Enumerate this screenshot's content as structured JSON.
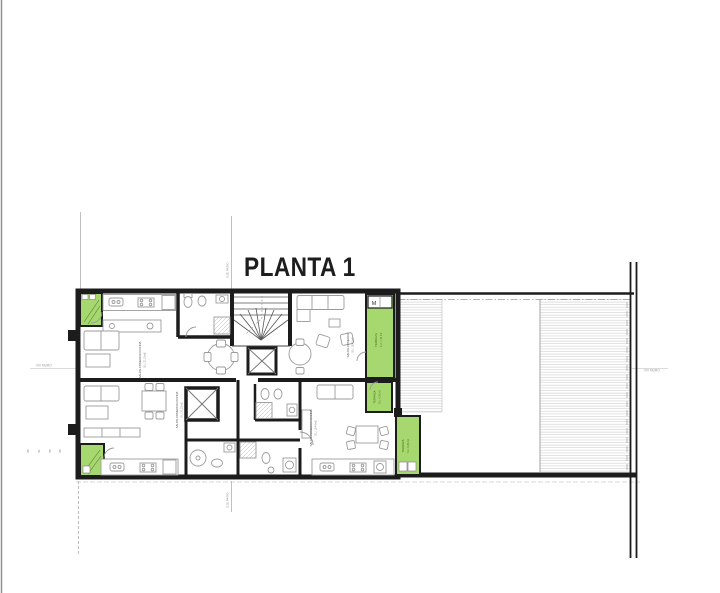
{
  "title": "PLANTA 1",
  "colors": {
    "wall": "#1c1c1c",
    "terrace_green": "#a7d86f",
    "terrace_border": "#3c660f",
    "furniture_gray": "#9b9b9b",
    "hatch_gray": "#cfcfcf",
    "reference_gray": "#a8a8a8",
    "background": "#ffffff"
  },
  "units": [
    {
      "id": "top-left",
      "label": "SALON-COMEDOR-COCINA",
      "area": "S.U. 21,15 m2"
    },
    {
      "id": "top-right",
      "label": "SALON-COMEDOR",
      "area": "S.U. 19,40 m2"
    },
    {
      "id": "bottom-left",
      "label": "SALON-COMEDOR-COCINA",
      "area": "S.U. 21,15 m2"
    },
    {
      "id": "bottom-right",
      "label": "SALON-COMEDOR-COCINA",
      "area": "S.U. 19,40 m2"
    }
  ],
  "terraces": [
    {
      "id": "ne",
      "label": "TERRAZA",
      "area": "S.U. 7,10 m2"
    },
    {
      "id": "se-upper",
      "label": "TERRAZA",
      "area": "S.U. 4,20 m2"
    },
    {
      "id": "se-lower",
      "label": "TERRAZA",
      "area": "S.U. 6,35 m2"
    }
  ],
  "annotations": {
    "closet": "M",
    "edge_left": "VIV MURO",
    "edge_right": "VIV MURO",
    "ref_top": "EJE PATIO",
    "ref_bottom": "EJE PATIO",
    "dims": [
      "05",
      "01",
      "58",
      "05"
    ]
  }
}
